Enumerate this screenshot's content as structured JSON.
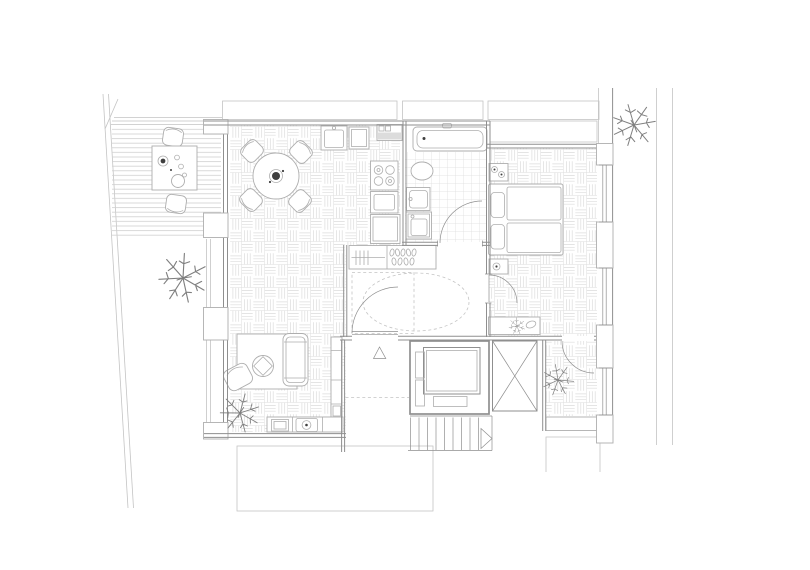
{
  "plan": {
    "type": "architectural-floor-plan",
    "description": "one-bedroom apartment with terrace, garden, loggia and stair/elevator core",
    "rooms": [
      {
        "name": "terrace",
        "features": [
          "wood-deck-boards",
          "outdoor-table",
          "two-outdoor-chairs",
          "tableware"
        ]
      },
      {
        "name": "garden",
        "features": [
          "tree"
        ]
      },
      {
        "name": "living-dining-room",
        "features": [
          "basketweave-parquet",
          "round-dining-table",
          "four-dining-chairs",
          "rug",
          "sofa",
          "round-coffee-table",
          "armchair",
          "sideboard",
          "tall-cabinet",
          "indoor-plant"
        ]
      },
      {
        "name": "kitchen",
        "features": [
          "sink-unit",
          "counter-unit",
          "boiler-unit",
          "cooktop-4-burners",
          "oven-unit",
          "fridge-unit"
        ]
      },
      {
        "name": "bathroom",
        "features": [
          "square-tile-floor",
          "bathtub",
          "toilet",
          "washbasin",
          "washing-machine",
          "door-swing"
        ]
      },
      {
        "name": "bedroom",
        "features": [
          "basketweave-parquet",
          "double-bed-two-mattresses",
          "two-pillows",
          "nightstand-with-plants",
          "nightstand-with-plant",
          "low-bench-with-plant",
          "door-swing"
        ]
      },
      {
        "name": "entrance-hall",
        "features": [
          "wardrobe-with-hangers",
          "shoe-shelf",
          "dashed-clearance-ellipse",
          "dashed-clearance-rect",
          "entrance-door-swing",
          "entrance-triangle-marker"
        ]
      },
      {
        "name": "corridor",
        "features": [
          "dashed-threshold-line"
        ]
      },
      {
        "name": "elevator",
        "features": [
          "elevator-car",
          "door-mechanism"
        ]
      },
      {
        "name": "staircase",
        "features": [
          "nine-risers",
          "direction-arrow"
        ]
      },
      {
        "name": "shaft",
        "features": [
          "diagonal-cross"
        ]
      },
      {
        "name": "loggia",
        "features": [
          "basketweave-parquet",
          "plant",
          "door-swing",
          "bench-sill"
        ]
      }
    ],
    "symbols": [
      "tree-icon",
      "plant-icon",
      "door-swing-arc",
      "stair-direction-arrow",
      "entrance-triangle-marker",
      "elevator-symbol",
      "shaft-cross-symbol",
      "window-double-line",
      "wall-pier"
    ],
    "counts": {
      "outdoor_trees": 2,
      "indoor_plants": 3,
      "loggia_plants": 1,
      "dining_chairs": 4,
      "terrace_chairs": 2,
      "stair_risers": 9
    }
  },
  "colors": {
    "background": "#ffffff",
    "wall": "#8f8f8f",
    "furniture": "#aeaeae",
    "floor_pattern": "#dcdcdc",
    "context_line": "#c4c4c4",
    "vegetation": "#7f7f7f",
    "accent_dark": "#3f3f3f"
  }
}
